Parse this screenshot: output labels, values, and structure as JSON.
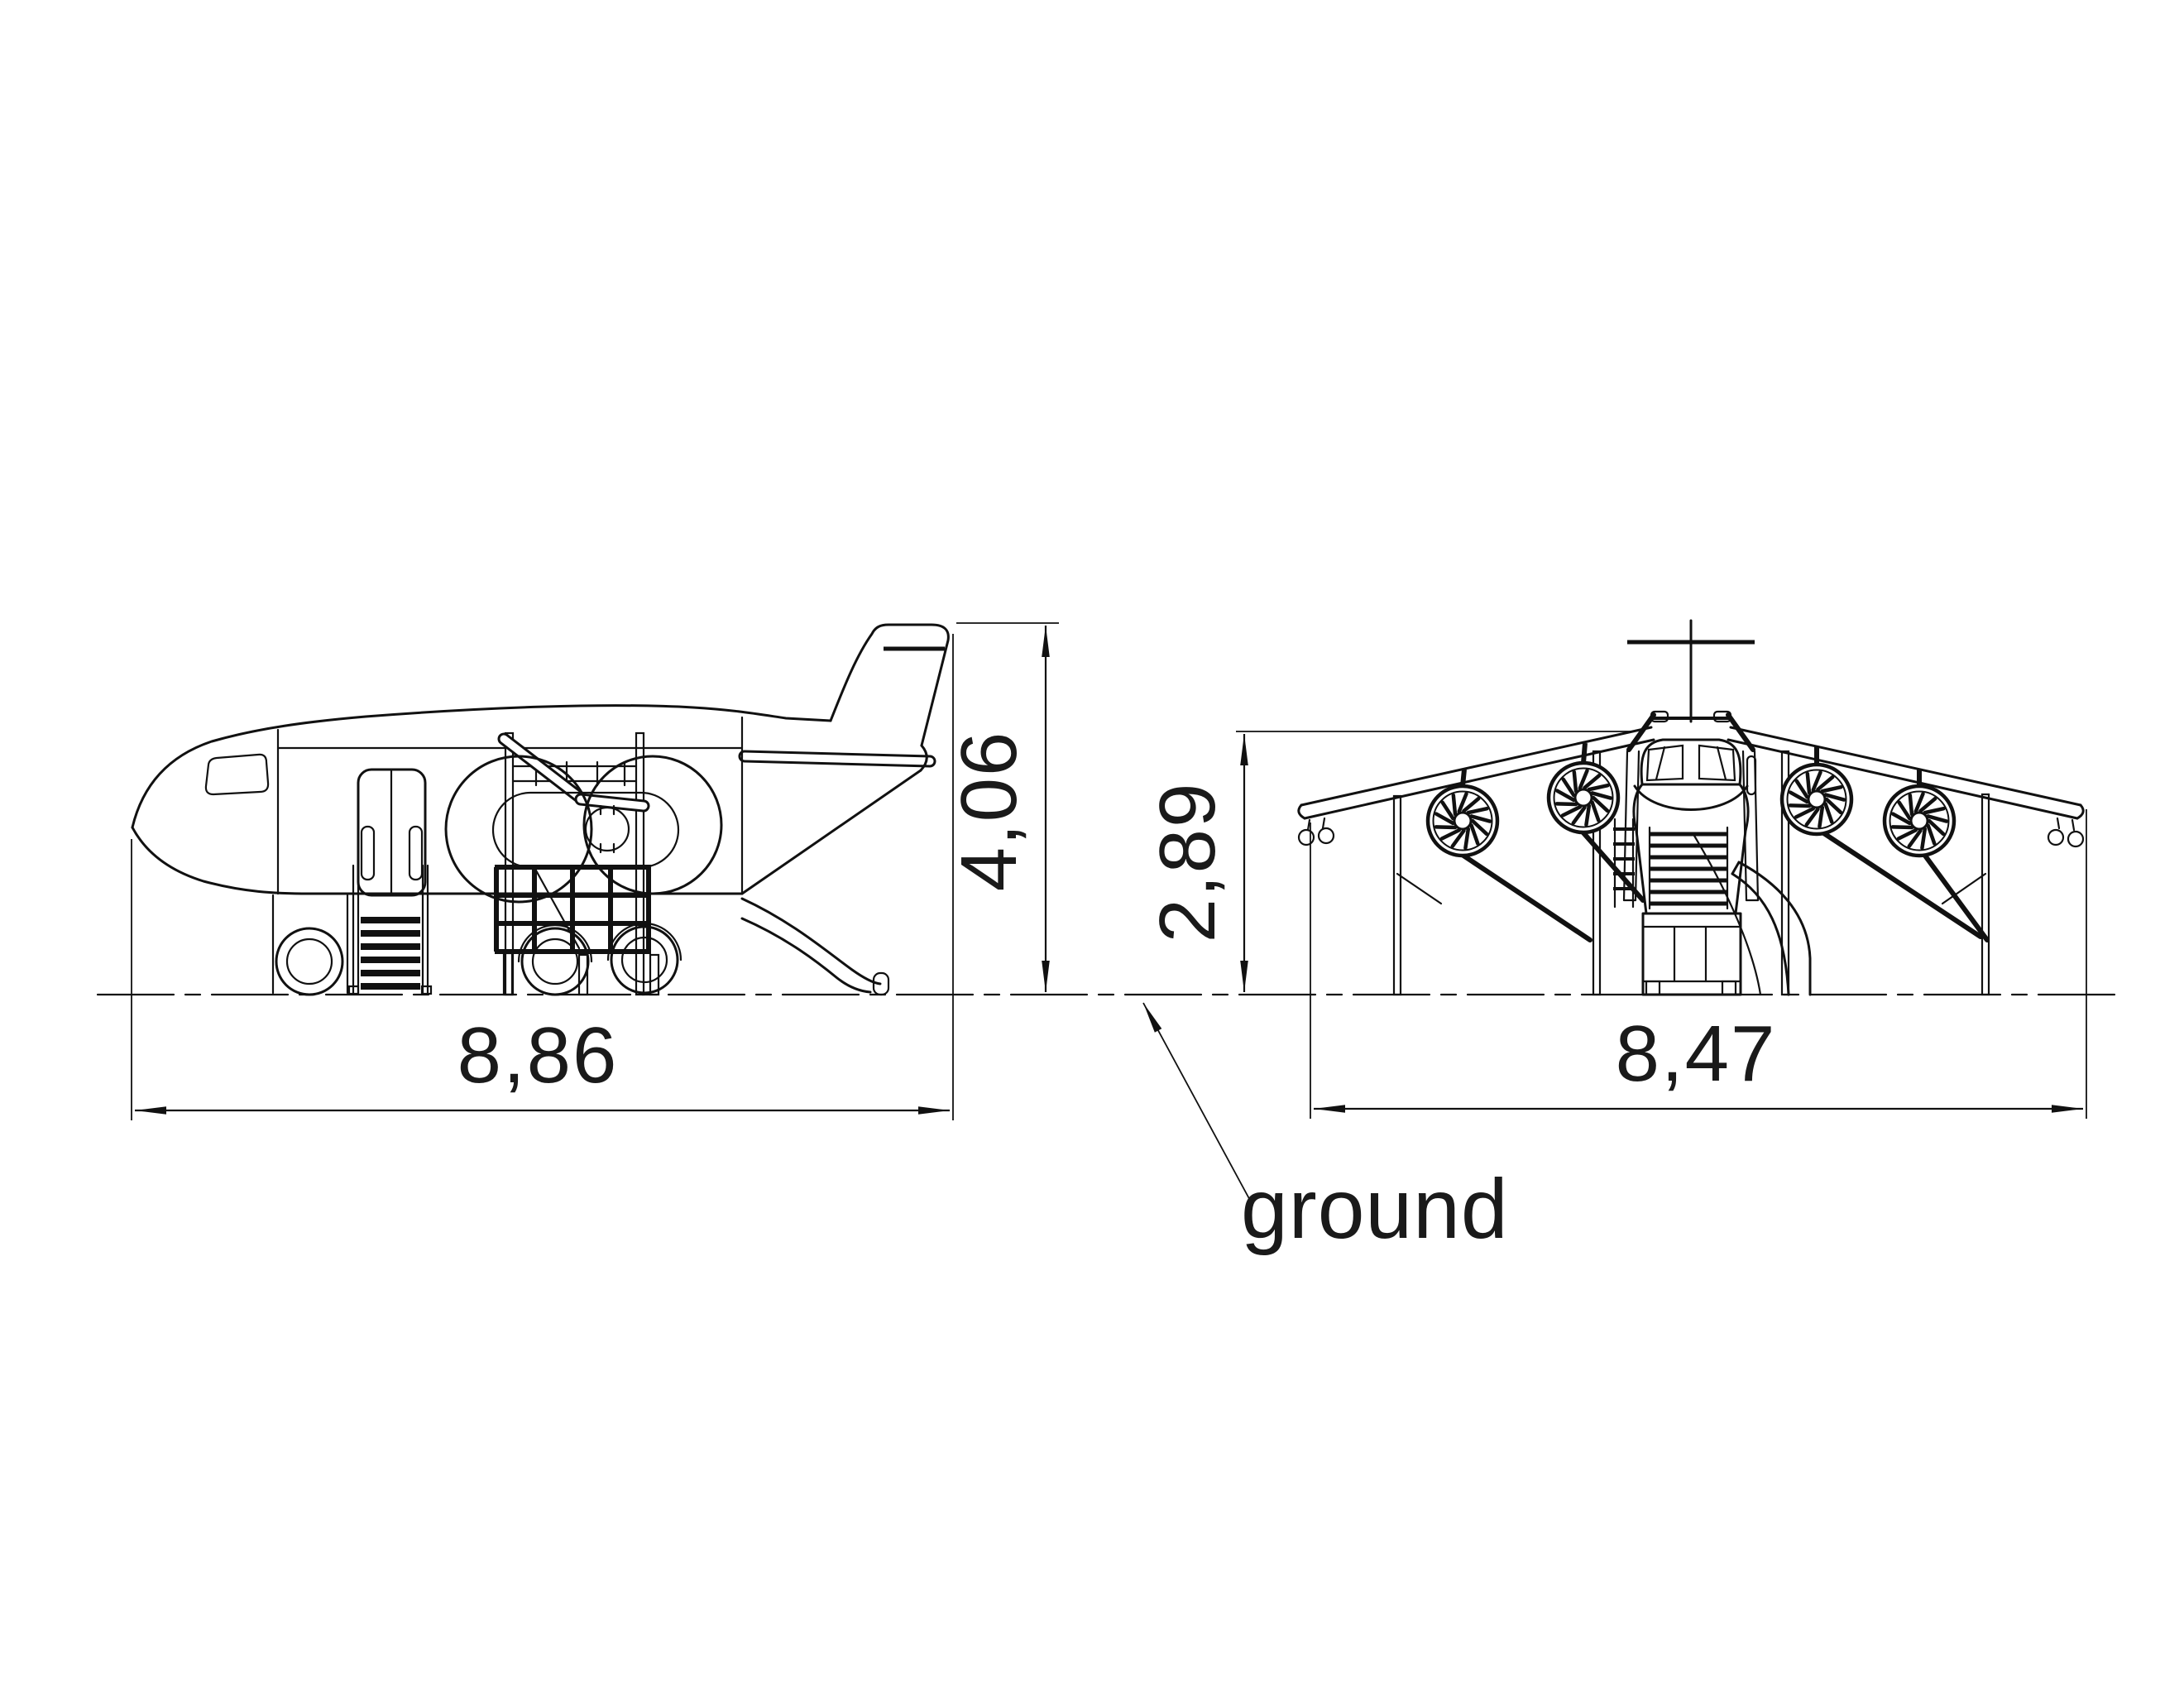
{
  "drawing": {
    "type": "technical-orthographic-drawing",
    "subject": "playground airplane structure, side view and front view",
    "line_color": "#111111",
    "background": "#ffffff",
    "side_view": {
      "length_label": "8,86",
      "height_label": "4,06"
    },
    "front_view": {
      "height_label": "2,89",
      "width_label": "8,47"
    },
    "ground_label": "ground"
  }
}
